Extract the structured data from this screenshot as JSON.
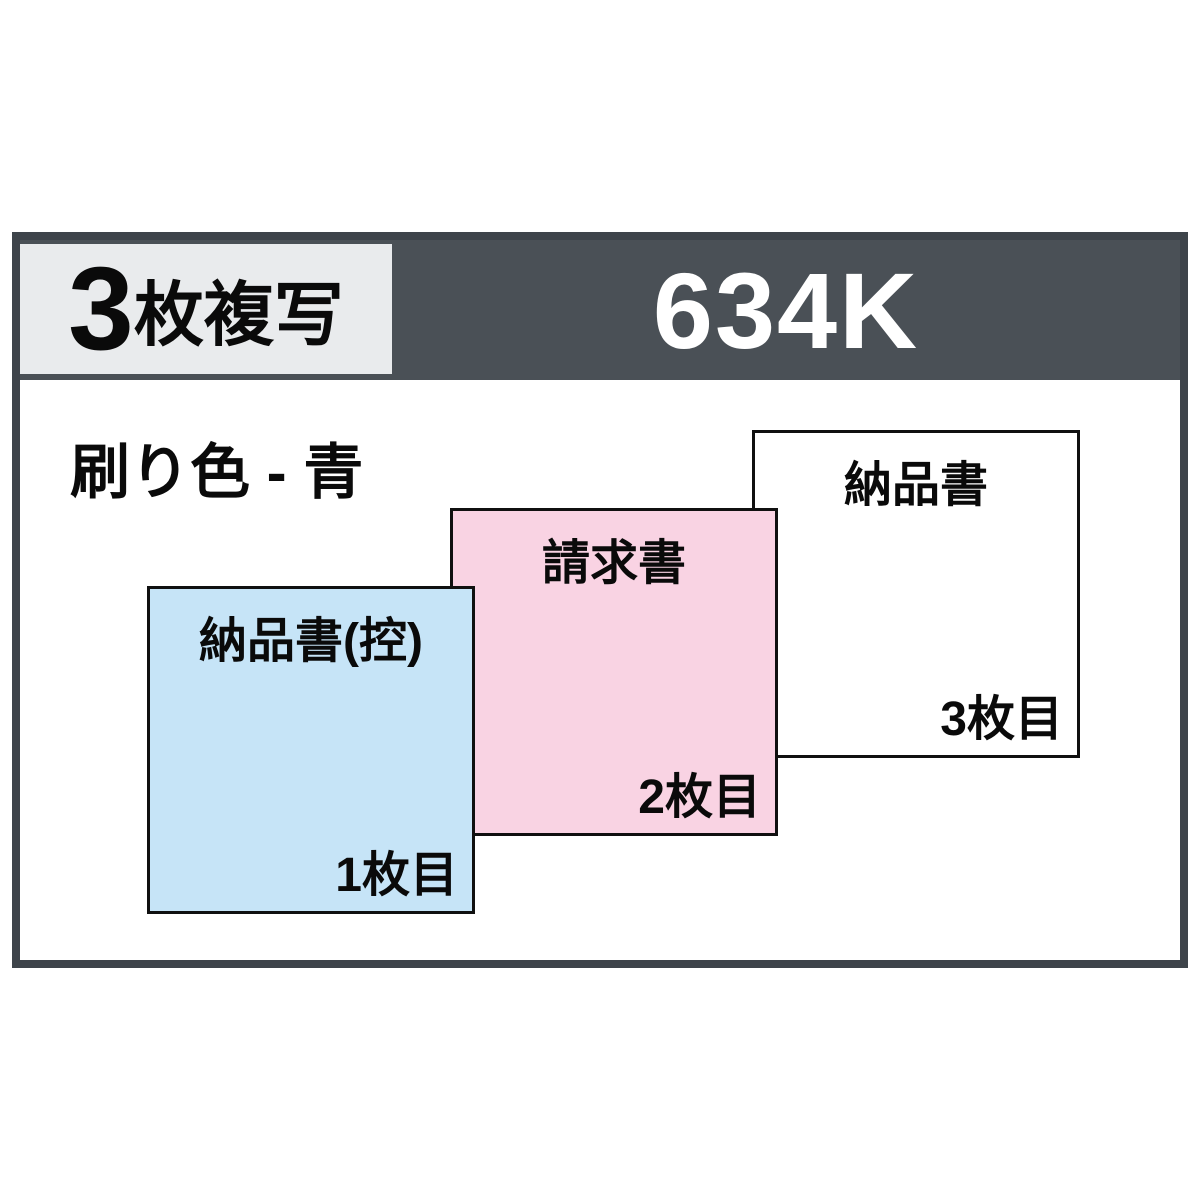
{
  "product": {
    "copies_count": "3",
    "copies_suffix": "枚複写",
    "model_number": "634K",
    "print_color_label": "刷り色 - 青"
  },
  "sheets": [
    {
      "title": "納品書(控)",
      "order_label": "1枚目",
      "fill_color": "#c6e4f7"
    },
    {
      "title": "請求書",
      "order_label": "2枚目",
      "fill_color": "#f9d3e3"
    },
    {
      "title": "納品書",
      "order_label": "3枚目",
      "fill_color": "#ffffff"
    }
  ],
  "colors": {
    "frame_border": "#3e444a",
    "header_background": "#4a5056",
    "badge_background": "#e9ebed",
    "model_text": "#ffffff",
    "sheet_border": "#101010",
    "sheet1_fill": "#c6e4f7",
    "sheet2_fill": "#f9d3e3",
    "sheet3_fill": "#ffffff"
  }
}
